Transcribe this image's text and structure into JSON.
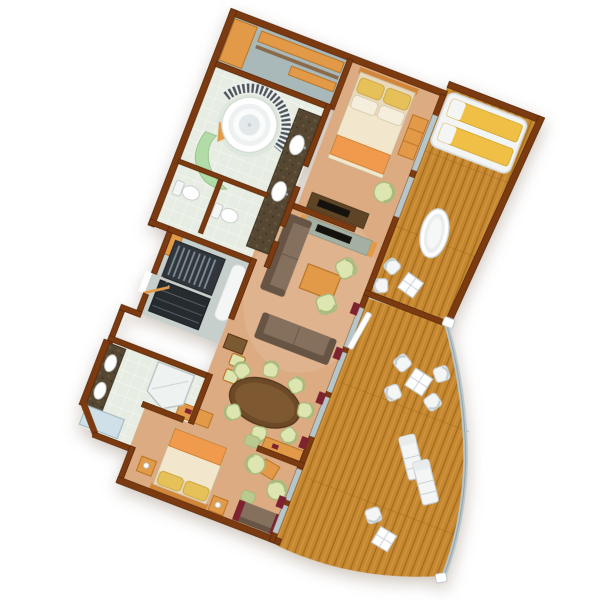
{
  "scene": {
    "type": "3d-floor-plan",
    "subject": "Two-bedroom ship suite floor plan with curved wraparound balcony, viewed top-down, rotated on white background",
    "background": "#ffffff"
  },
  "rooms": [
    {
      "id": "walk-in-closet",
      "label": "Walk-in closet",
      "items": [
        "corner-cabinet",
        "shelving",
        "hanging-rail"
      ]
    },
    {
      "id": "master-bathroom",
      "label": "Master bathroom",
      "items": [
        "round-whirlpool-tub",
        "curved-towel-shelf",
        "green-glass-shower",
        "double-vanity",
        "two-toilet-rooms"
      ]
    },
    {
      "id": "master-bedroom",
      "label": "Master bedroom",
      "items": [
        "double-bed",
        "dresser",
        "armchair",
        "tv-cabinet"
      ]
    },
    {
      "id": "living-room",
      "label": "Living room",
      "items": [
        "wall-sofa",
        "center-sofa",
        "coffee-table",
        "two-armchairs",
        "tv-console",
        "open-glass-door"
      ]
    },
    {
      "id": "foyer-pantry",
      "label": "Entrance foyer and pantry",
      "items": [
        "hanger-wardrobe",
        "pantry-shelves",
        "white-bench",
        "entry-door",
        "corner-cabinet"
      ]
    },
    {
      "id": "dining-area",
      "label": "Dining area",
      "items": [
        "oval-dining-table",
        "dining-chairs",
        "two-stools",
        "tall-cabinet",
        "two-sideboards",
        "ottoman"
      ]
    },
    {
      "id": "guest-bathroom",
      "label": "Guest bathroom",
      "items": [
        "double-vanity",
        "corner-shower",
        "shower-tray"
      ]
    },
    {
      "id": "second-bedroom",
      "label": "Second bedroom",
      "items": [
        "double-bed",
        "two-nightstands",
        "two-barrel-armchairs",
        "side-table",
        "ottoman",
        "sofa"
      ]
    },
    {
      "id": "upper-veranda",
      "label": "Enclosed veranda with outdoor bath",
      "items": [
        "canopy-daybed",
        "freestanding-bathtub",
        "two-chairs",
        "pane-table"
      ]
    },
    {
      "id": "curved-balcony",
      "label": "Curved open balcony",
      "items": [
        "four-chairs",
        "pane-table",
        "two-sun-loungers",
        "chair",
        "pane-table-small",
        "curved-railing"
      ]
    }
  ],
  "stats": {
    "dining_chairs": 7,
    "balcony_sun_loungers": 2,
    "balcony_chairs": 5,
    "veranda_chairs": 2,
    "bathrooms": 2,
    "bedrooms": 2
  },
  "colors": {
    "wall": "#7b3a10",
    "wallDark": "#57280a",
    "carpet": "#dcab81",
    "carpetLight": "#ecc79f",
    "closetFloor": "#a9b9ba",
    "foyerFloor": "#c6cfcc",
    "tile": "#e7ede3",
    "tileLine": "#f7faf5",
    "deck": "#c5872f",
    "deckLine": "#9e671d",
    "wood": "#e29a48",
    "woodDark": "#b5701f",
    "woodDeep": "#7a5a33",
    "cabinetDark": "#5f4526",
    "sofa": "#84705c",
    "sofaDark": "#685444",
    "cushion": "#dde6b0",
    "cushionEdge": "#aaba7e",
    "cushionDark": "#b9c98f",
    "tableWood": "#6d4a27",
    "tableWoodDark": "#54381d",
    "tableTop": "#7d5831",
    "bedSheet": "#f2e7cd",
    "bedFrame": "#e8d9bd",
    "pillowGold": "#e6c159",
    "pillowCream": "#f6eedd",
    "runner": "#f09a4e",
    "headboard": "#d2863a",
    "white": "#ffffff",
    "porcelain": "#f4f6f5",
    "fixtureLine": "#c6cdd1",
    "glass": "#b7c6c9",
    "glassGreen": "#a6d89a",
    "marble": "#564732",
    "marbleLight": "#6f5d42",
    "maroon": "#7e2230",
    "railing": "#b9c6ca",
    "tv": "#15120d",
    "wardrobe": "#30363b",
    "pantry": "#262b30",
    "hanger": "#7c8b94",
    "daybed": "#efc045",
    "showerTray": "#cfe0e8",
    "shelfArc": "#4d565c"
  }
}
